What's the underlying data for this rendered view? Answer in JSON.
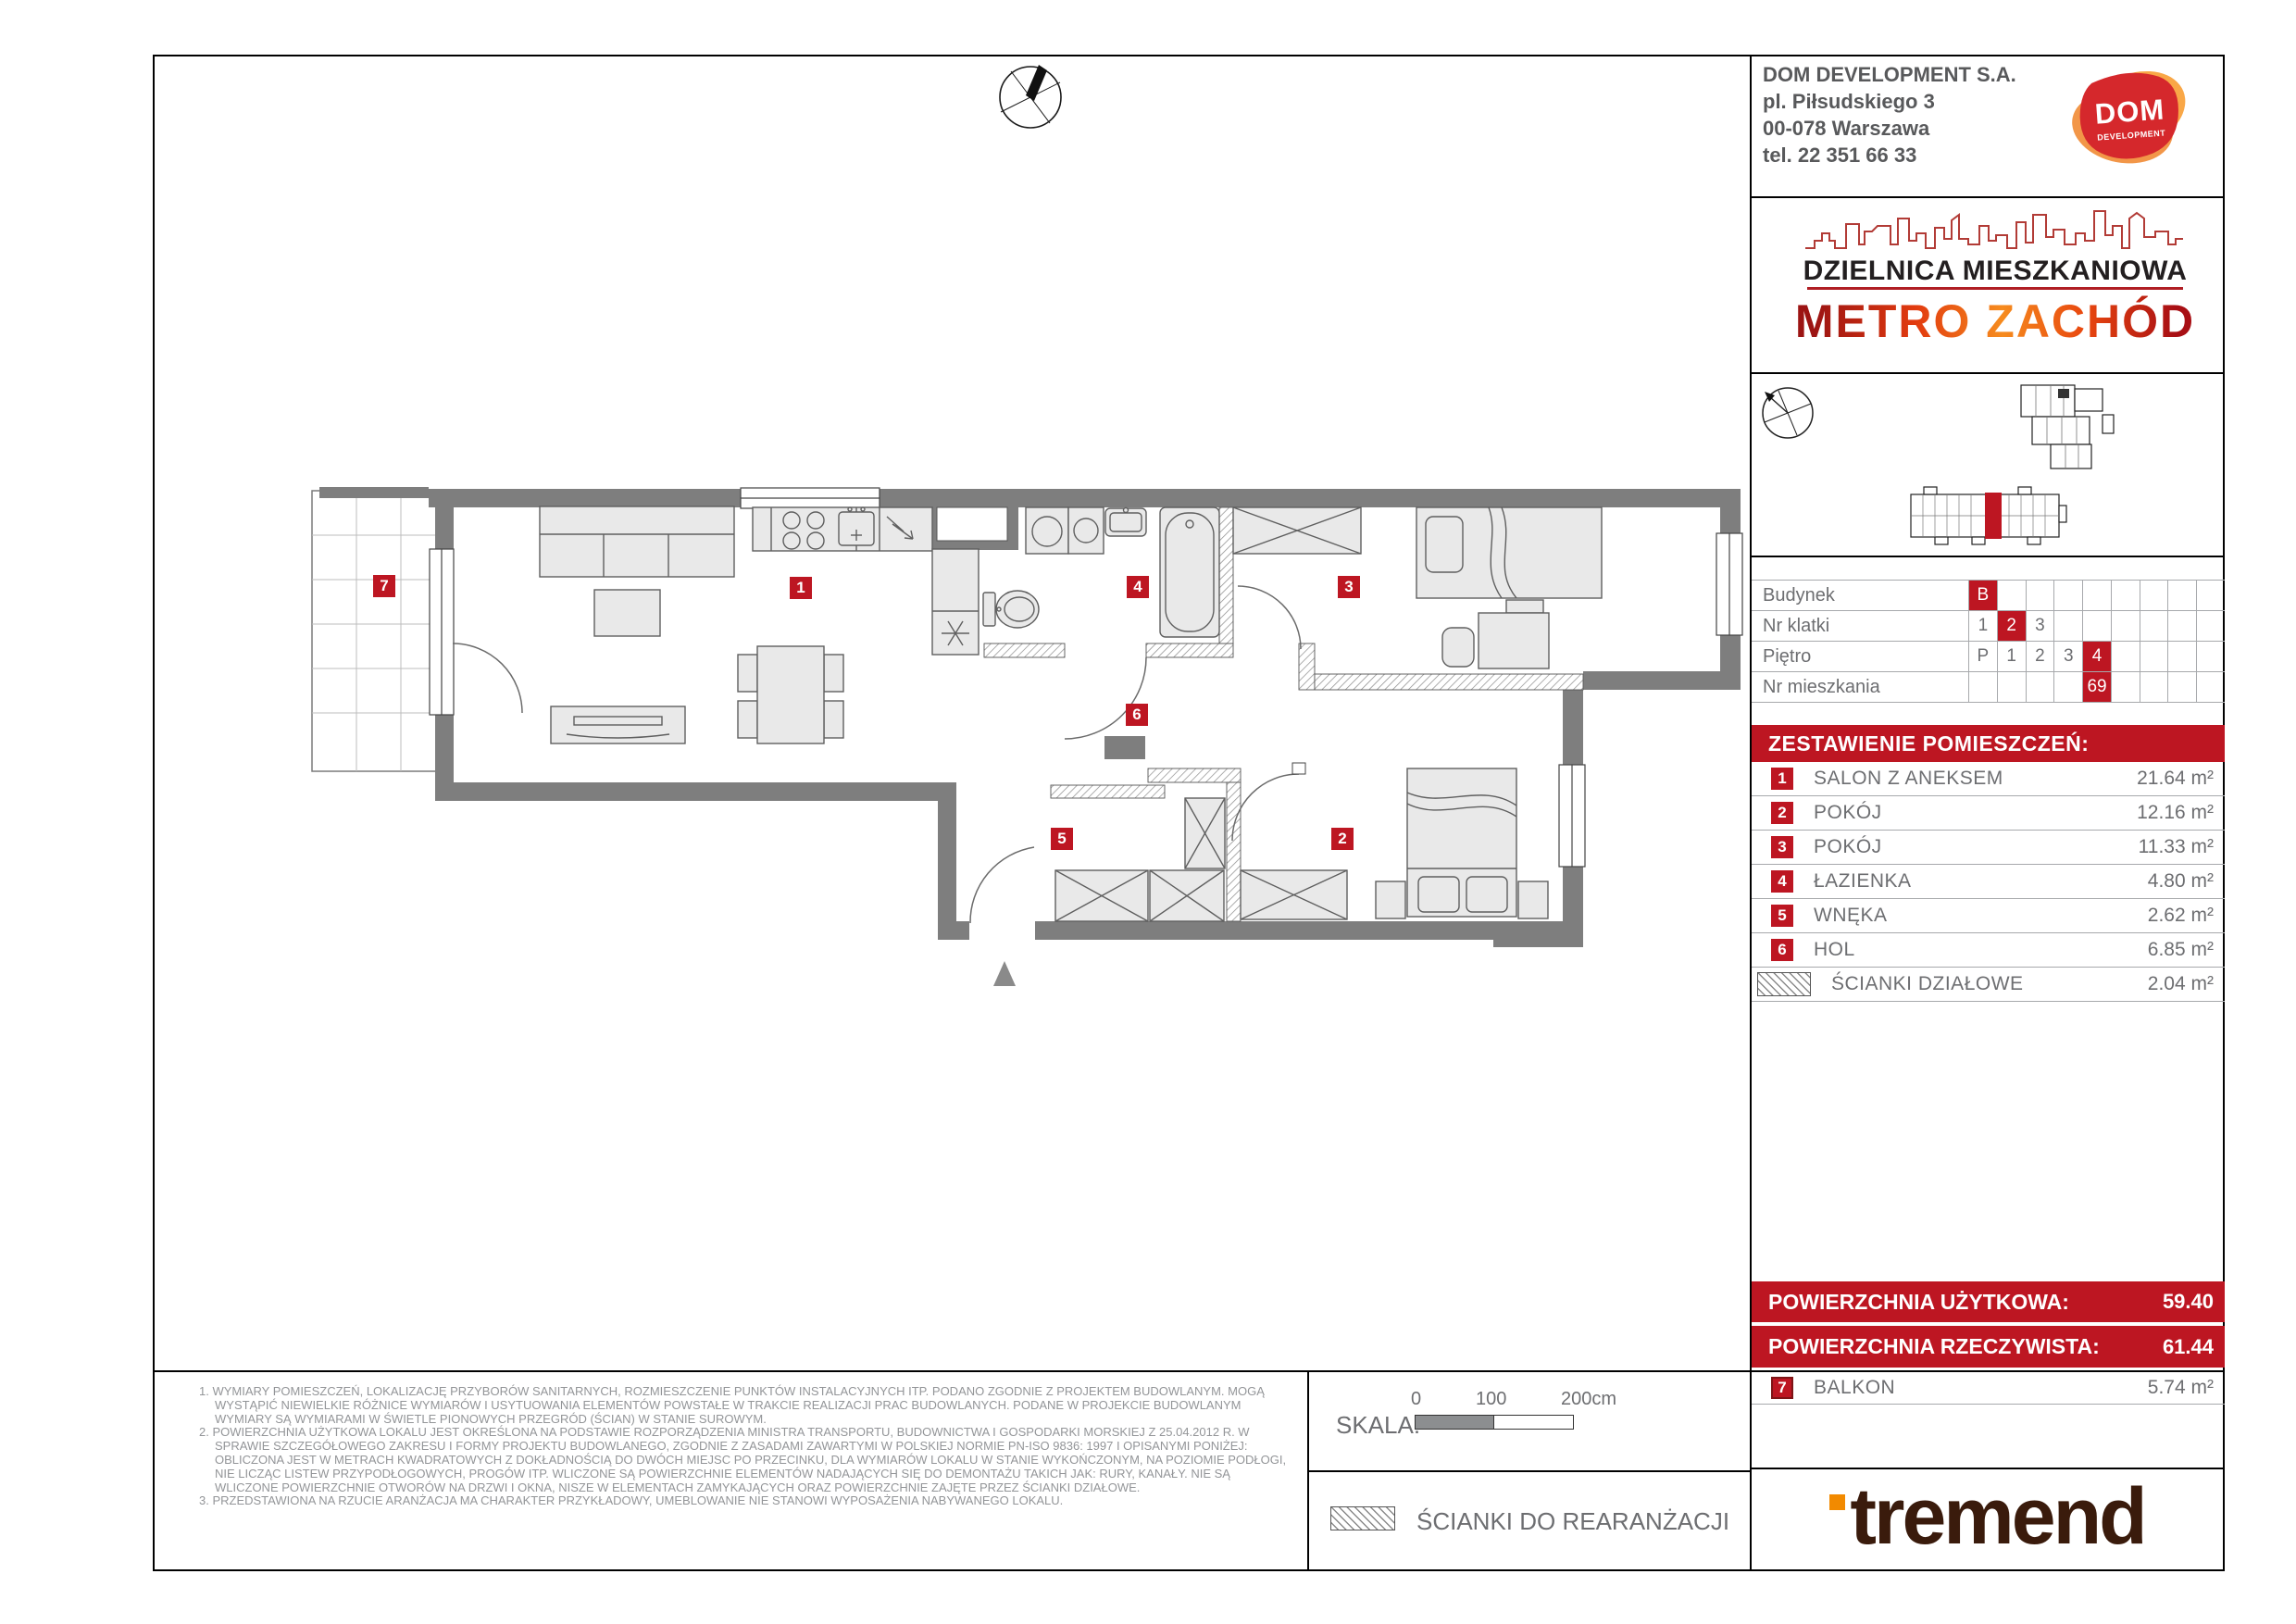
{
  "colors": {
    "accent_red": "#bd1622",
    "wall_gray": "#7e7e7e",
    "text_gray": "#6d6e71",
    "note_gray": "#939598",
    "tremend_brown": "#3a1b0c",
    "tremend_orange": "#f28a00",
    "metro_orange": "#f68b1e",
    "metro_dark": "#9c1413"
  },
  "developer": {
    "name": "DOM DEVELOPMENT S.A.",
    "address_line1": "pl. Piłsudskiego 3",
    "address_line2": "00-078 Warszawa",
    "phone": "tel. 22 351 66 33",
    "logo_text": "DOM",
    "logo_subtext": "DEVELOPMENT"
  },
  "project": {
    "tagline": "DZIELNICA MIESZKANIOWA",
    "name": "METRO ZACHÓD"
  },
  "unit_info": {
    "columns": 9,
    "rows": [
      {
        "label": "Budynek",
        "cells": [
          {
            "v": "B",
            "hl": true
          }
        ]
      },
      {
        "label": "Nr klatki",
        "cells": [
          {
            "v": "1"
          },
          {
            "v": "2",
            "hl": true
          },
          {
            "v": "3"
          }
        ]
      },
      {
        "label": "Piętro",
        "cells": [
          {
            "v": "P"
          },
          {
            "v": "1"
          },
          {
            "v": "2"
          },
          {
            "v": "3"
          },
          {
            "v": "4",
            "hl": true
          }
        ]
      },
      {
        "label": "Nr mieszkania",
        "cells": [
          {
            "v": ""
          },
          {
            "v": ""
          },
          {
            "v": ""
          },
          {
            "v": ""
          },
          {
            "v": "69",
            "hl": true
          }
        ]
      }
    ]
  },
  "rooms": {
    "title": "ZESTAWIENIE POMIESZCZEŃ:",
    "rows": [
      {
        "num": "1",
        "name": "SALON Z ANEKSEM",
        "area": "21.64 m²"
      },
      {
        "num": "2",
        "name": "POKÓJ",
        "area": "12.16 m²"
      },
      {
        "num": "3",
        "name": "POKÓJ",
        "area": "11.33 m²"
      },
      {
        "num": "4",
        "name": "ŁAZIENKA",
        "area": "4.80 m²"
      },
      {
        "num": "5",
        "name": "WNĘKA",
        "area": "2.62 m²"
      },
      {
        "num": "6",
        "name": "HOL",
        "area": "6.85 m²"
      },
      {
        "num": "",
        "name": "ŚCIANKI DZIAŁOWE",
        "area": "2.04 m²"
      }
    ]
  },
  "areas": {
    "usable_label": "POWIERZCHNIA UŻYTKOWA:",
    "usable_value": "59.40",
    "actual_label": "POWIERZCHNIA RZECZYWISTA:",
    "actual_value": "61.44"
  },
  "balcony_row": {
    "num": "7",
    "name": "BALKON",
    "area": "5.74 m²"
  },
  "plan": {
    "markers": [
      "1",
      "2",
      "3",
      "4",
      "5",
      "6",
      "7"
    ]
  },
  "scale_bar": {
    "label": "SKALA:",
    "tick0": "0",
    "tick1": "100",
    "tick2": "200cm"
  },
  "legend": {
    "rearrangement": "ŚCIANKI DO REARANŻACJI"
  },
  "footer_logo": {
    "text": "tremend"
  },
  "footnotes": [
    "1. WYMIARY POMIESZCZEŃ, LOKALIZACJĘ PRZYBORÓW SANITARNYCH, ROZMIESZCZENIE PUNKTÓW INSTALACYJNYCH ITP. PODANO ZGODNIE Z PROJEKTEM BUDOWLANYM. MOGĄ WYSTĄPIĆ NIEWIELKIE RÓŻNICE WYMIARÓW I USYTUOWANIA ELEMENTÓW POWSTAŁE W TRAKCIE REALIZACJI PRAC BUDOWLANYCH. PODANE W PROJEKCIE BUDOWLANYM WYMIARY SĄ WYMIARAMI W ŚWIETLE PIONOWYCH PRZEGRÓD (ŚCIAN) W STANIE SUROWYM.",
    "2. POWIERZCHNIA UŻYTKOWA LOKALU JEST OKREŚLONA NA PODSTAWIE ROZPORZĄDZENIA MINISTRA TRANSPORTU, BUDOWNICTWA I GOSPODARKI MORSKIEJ Z 25.04.2012 R. W SPRAWIE SZCZEGÓŁOWEGO ZAKRESU I FORMY PROJEKTU BUDOWLANEGO, ZGODNIE Z ZASADAMI ZAWARTYMI W POLSKIEJ NORMIE PN-ISO 9836: 1997 I OPISANYMI PONIŻEJ: OBLICZONA JEST W METRACH KWADRATOWYCH Z DOKŁADNOŚCIĄ DO DWÓCH MIEJSC PO PRZECINKU, DLA WYMIARÓW LOKALU W STANIE WYKOŃCZONYM, NA POZIOMIE PODŁOGI, NIE LICZĄC LISTEW PRZYPODŁOGOWYCH, PROGÓW ITP. WLICZONE SĄ POWIERZCHNIE ELEMENTÓW NADAJĄCYCH SIĘ DO DEMONTAŻU TAKICH JAK: RURY, KANAŁY. NIE SĄ WLICZONE POWIERZCHNIE OTWORÓW NA DRZWI I OKNA, NISZE W ELEMENTACH ZAMYKAJĄCYCH ORAZ POWIERZCHNIE ZAJĘTE PRZEZ ŚCIANKI DZIAŁOWE.",
    "3. PRZEDSTAWIONA NA RZUCIE ARANŻACJA MA CHARAKTER PRZYKŁADOWY, UMEBLOWANIE NIE STANOWI WYPOSAŻENIA NABYWANEGO LOKALU."
  ]
}
